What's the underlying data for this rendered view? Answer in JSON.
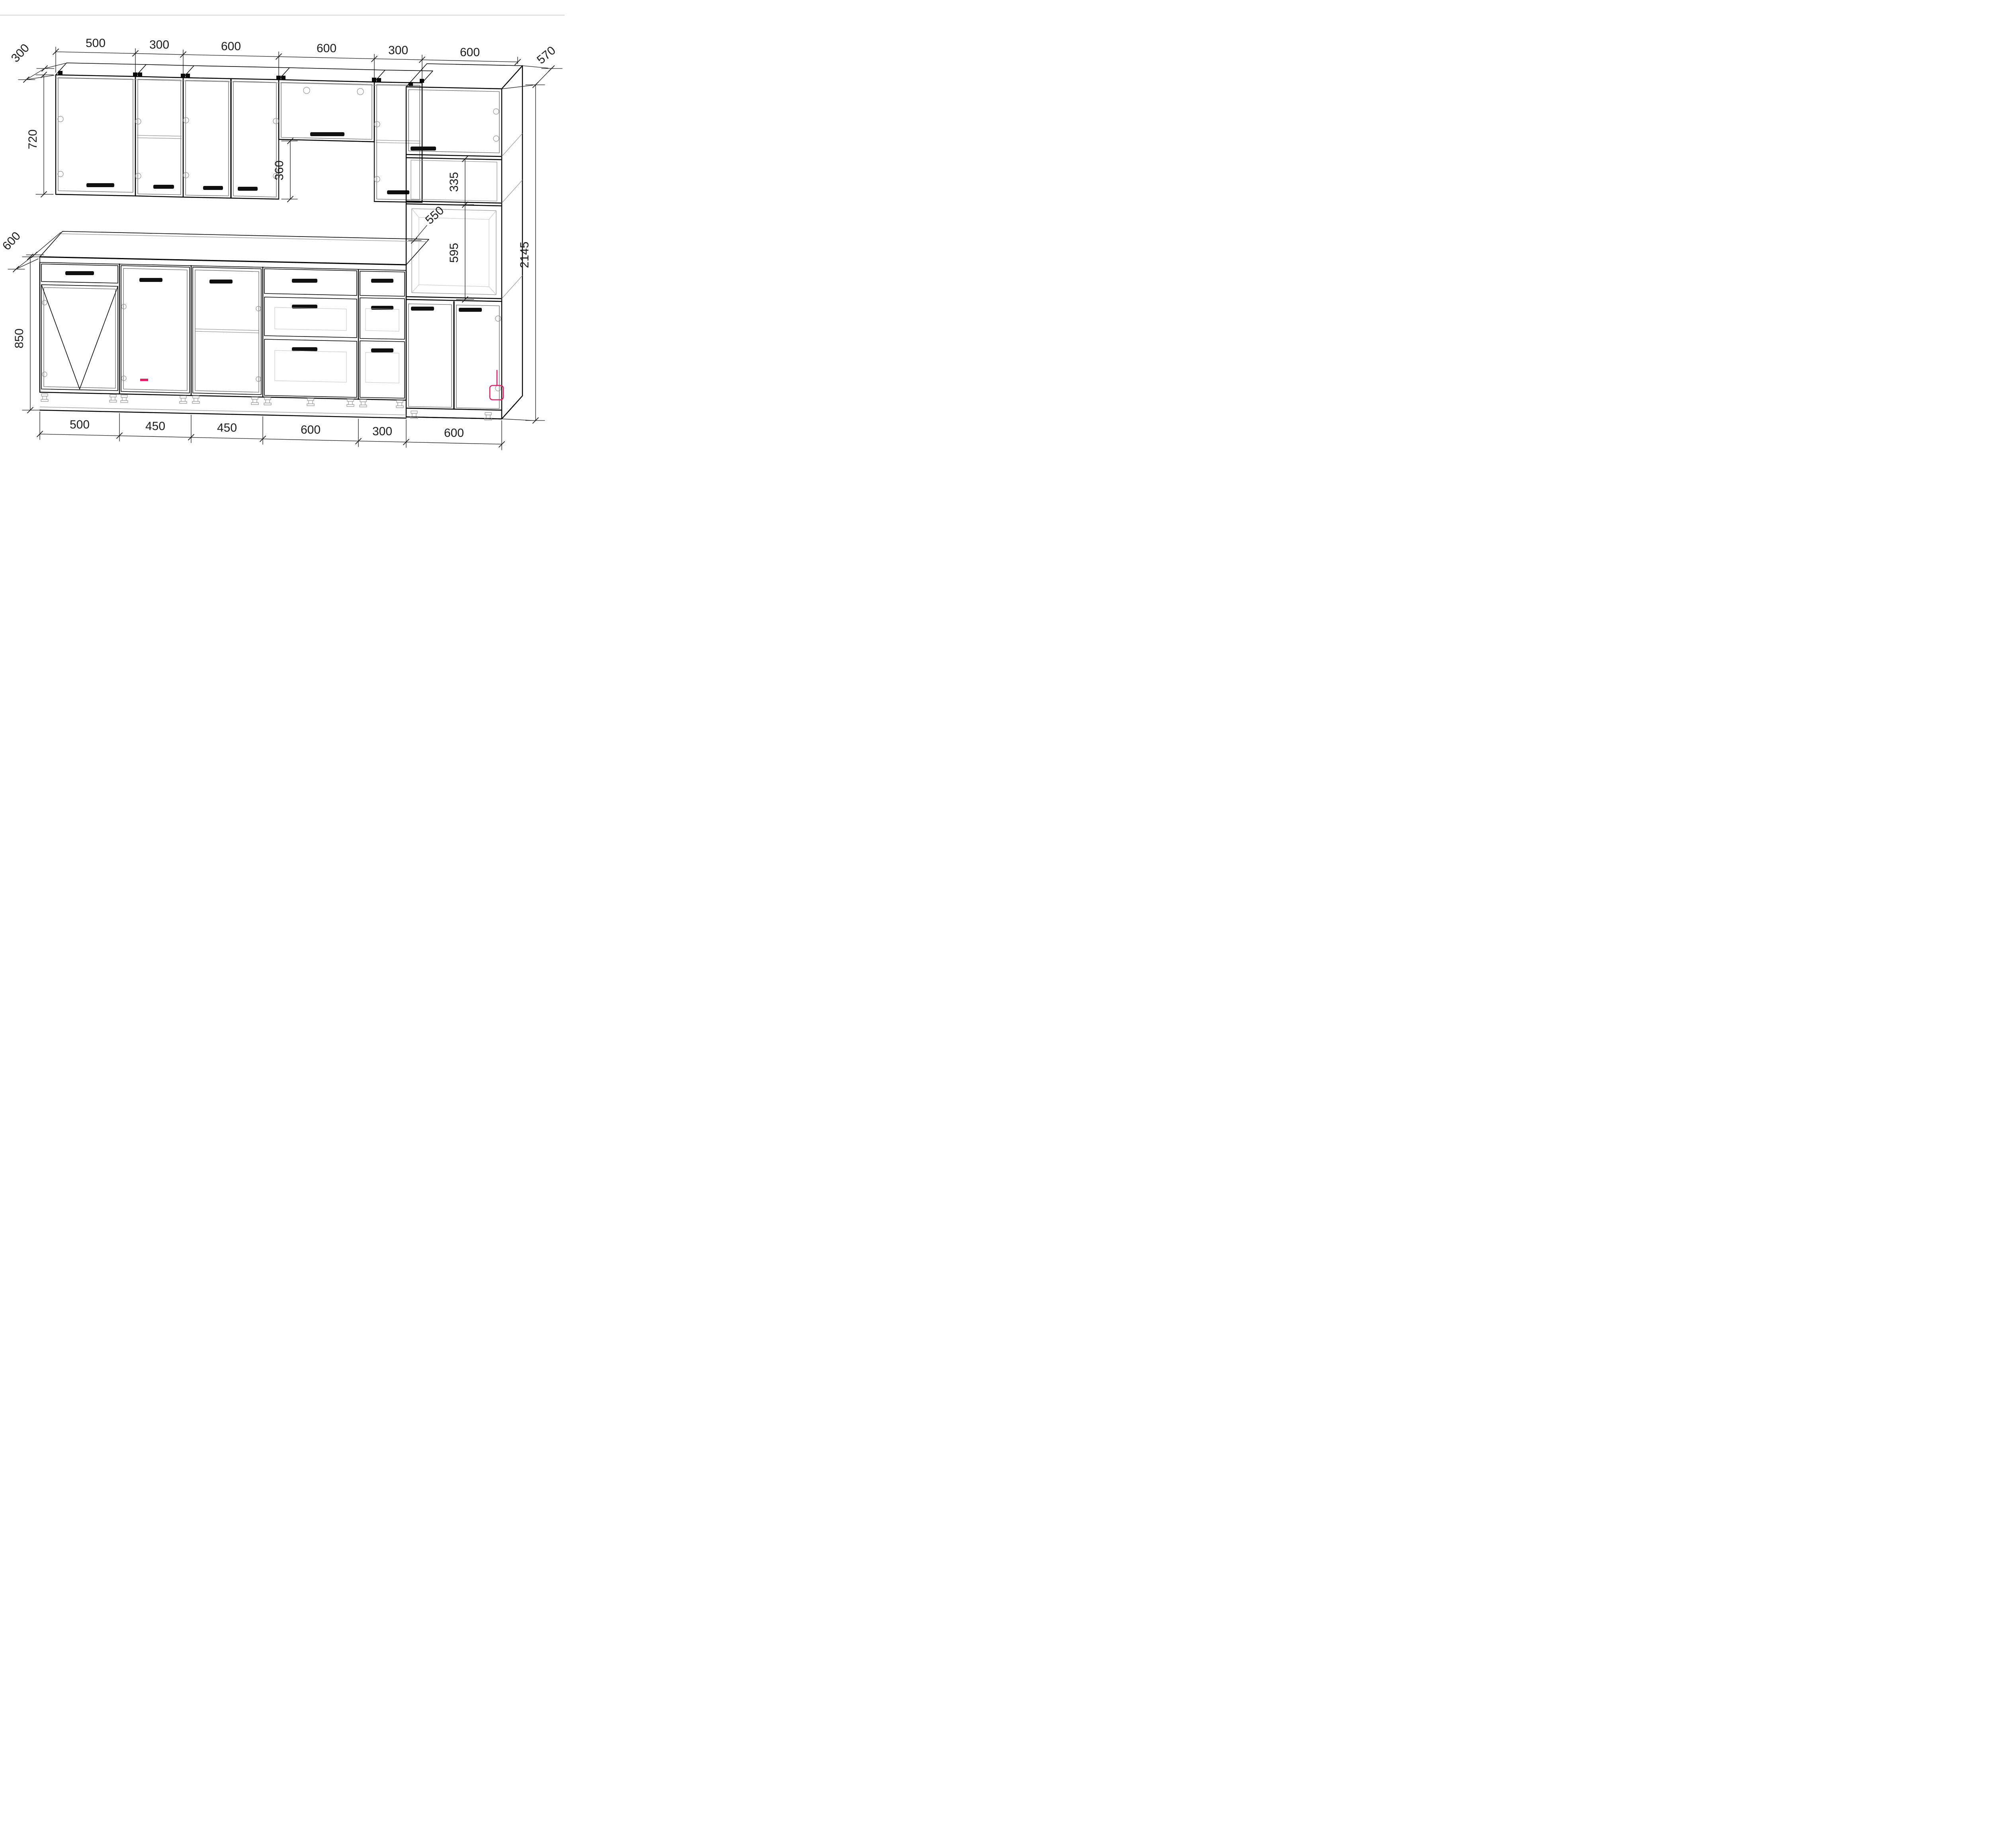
{
  "meta": {
    "drawing_type": "kitchen cabinet set, axonometric technical drawing",
    "units": "mm"
  },
  "dims": {
    "top_chain": [
      "500",
      "300",
      "600",
      "600",
      "300",
      "600"
    ],
    "bottom_chain": [
      "500",
      "450",
      "450",
      "600",
      "300",
      "600"
    ],
    "wall_depth": "300",
    "wall_height": "720",
    "lift_gap": "360",
    "counter_depth": "600",
    "base_height": "850",
    "tall_depth": "570",
    "shelf_section": "335",
    "niche_width": "550",
    "niche_height": "595",
    "total_height": "2145"
  },
  "colors": {
    "line": "#000000",
    "thin_line": "#8f8f8f",
    "light_line": "#c0c0c0",
    "accent": "#e81e63",
    "text": "#1c1c1c",
    "background": "#ffffff"
  }
}
